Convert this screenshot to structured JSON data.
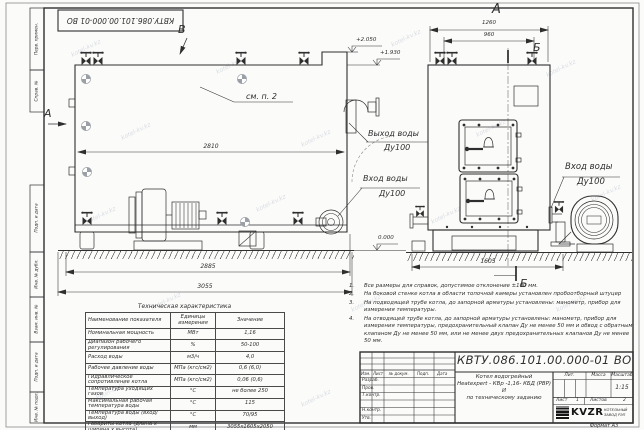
{
  "sheet": {
    "doc_number": "КВТУ.086.101.00.000-01 ВО",
    "corner_doc_number": "КВТУ.086.101.00.000-01 ВО",
    "format_note": "Формат А3",
    "watermark": "kotel-kv.kz"
  },
  "margin_labels": {
    "perv_primen": "Перв. примен.",
    "sprav_no": "Справ. №",
    "podp_data_1": "Подп. и дата",
    "inv_dubl": "Инв. № дубл.",
    "vzam_inv": "Взам. инв. №",
    "podp_data_2": "Подп. и дата",
    "inv_podl": "Инв. № подл."
  },
  "side_view": {
    "label_b": "В",
    "label_a": "А",
    "see_note": "см. п. 2",
    "elev_top": "+2.050",
    "elev_mid": "+1.930",
    "elev_zero": "0.000",
    "dim_inner": "2810",
    "dim_mid": "2885",
    "dim_total": "3055",
    "outlet_title": "Выход воды",
    "outlet_dn": "Ду100",
    "inlet_title": "Вход воды",
    "inlet_dn": "Ду100"
  },
  "front_view": {
    "label_a": "А",
    "label_b_top": "Б",
    "label_b_bottom": "Б",
    "dim_total": "1260",
    "dim_inner": "960",
    "dim_width": "1605",
    "inlet_title": "Вход воды",
    "inlet_dn": "Ду100"
  },
  "notes": [
    {
      "n": "1.",
      "text": "Все размеры для справок, допустимое отклонение ±100 мм."
    },
    {
      "n": "2.",
      "text": "На боковой стенке котла в области топочной камеры установлен пробоотборный штуцер"
    },
    {
      "n": "3.",
      "text": "На подводящей трубе котла, до запорной арматуры установлены: манометр, прибор для измерения температуры."
    },
    {
      "n": "4.",
      "text": "На отводящей трубе котла, до запорной арматуры установлены: манометр, прибор для измерения температуры, предохранительный клапан Ду не менее 50 мм и обвод с обратным клапаном Ду не менее 50 мм, или не менее двух предохранительных клапанов Ду не менее 50 мм."
    }
  ],
  "spec_table": {
    "title": "Техническая характеристика",
    "col_name": "Наименование показателя",
    "col_units": "Единицы измерения",
    "col_value": "Значение",
    "rows": [
      {
        "name": "Номинальная мощность",
        "units": "МВт",
        "value": "1,16"
      },
      {
        "name": "Диапазон рабочего регулирования",
        "units": "%",
        "value": "50-100"
      },
      {
        "name": "Расход воды",
        "units": "м3/ч",
        "value": "4,0"
      },
      {
        "name": "Рабочее давление воды",
        "units": "МПа (кгс/см2)",
        "value": "0,6 (6,0)"
      },
      {
        "name": "Гидравлическое сопротивление котла",
        "units": "МПа (кгс/см2)",
        "value": "0,06 (0,6)"
      },
      {
        "name": "Температура уходящих газов",
        "units": "°С",
        "value": "не более 250"
      },
      {
        "name": "Максимальная рабочая температура воды",
        "units": "°С",
        "value": "115"
      },
      {
        "name": "Температура воды (вход/выход)",
        "units": "°С",
        "value": "70/95"
      },
      {
        "name": "Габариты котла (длина х ширина х высота)",
        "units": "мм",
        "value": "3055х1605х2050"
      }
    ]
  },
  "title_block": {
    "doc_number": "КВТУ.086.101.00.000-01 ВО",
    "name_line1": "Котел водогрейный",
    "name_line2": "Heatexpert - КВр -1,16- КБД (РВР) И",
    "name_line3": "по техническому заданию",
    "th_izm": "Изм.",
    "th_list": "Лист",
    "th_docum": "№ докум.",
    "th_podp": "Подп.",
    "th_data": "Дата",
    "rows": [
      "Разраб.",
      "Пров.",
      "Т.контр.",
      "",
      "Н.контр.",
      "Утв."
    ],
    "lit_label": "Лит.",
    "mass_label": "Масса",
    "scale_label": "Масштаб",
    "scale_value": "1:15",
    "sheet_label": "Лист",
    "sheet_value": "1",
    "sheets_label": "Листов",
    "sheets_value": "2",
    "logo_text": "KVZR",
    "company_line1": "КОТЕЛЬНЫЙ",
    "company_line2": "ЗАВОД РЭП"
  }
}
